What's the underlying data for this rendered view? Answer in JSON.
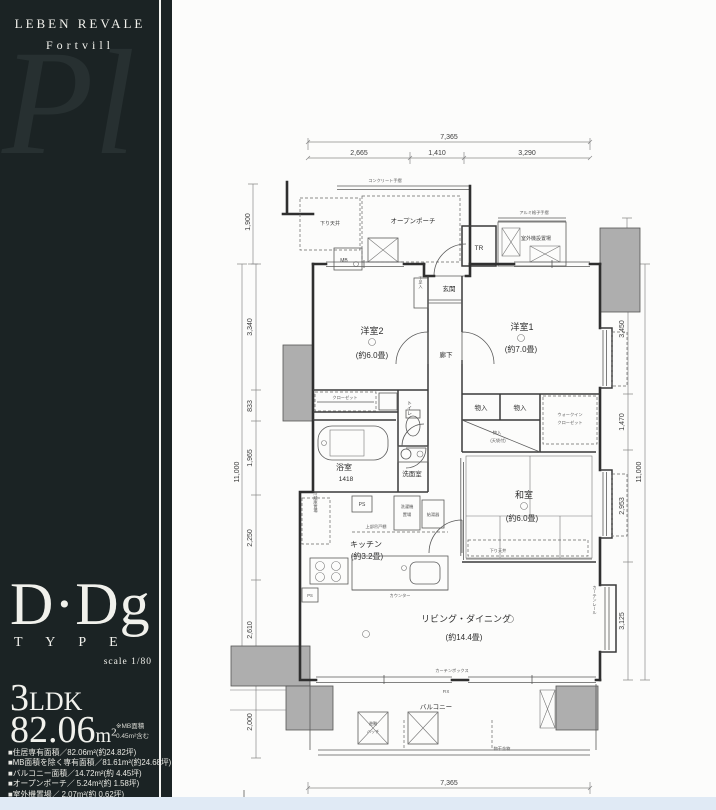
{
  "sidebar": {
    "brand_line1": "LEBEN REVALE",
    "brand_line2": "Fortvill",
    "watermark": "Pl",
    "type_main": "D·Dg",
    "type_sub": "T Y P E",
    "scale": "scale 1/80",
    "ldk_number": "3",
    "ldk_suffix": "LDK",
    "area_value": "82.06",
    "area_unit": "m",
    "area_sup": "2",
    "area_note1": "※MB面積",
    "area_note2": "0.45m²含む",
    "specs": [
      "■住居専有面積／82.06m²(約24.82坪)",
      "■MB面積を除く専有面積／81.61m²(約24.68坪)",
      "■バルコニー面積／14.72m²(約 4.45坪)",
      "■オープンポーチ／ 5.24m²(約 1.58坪)",
      "■室外機置場／ 2.07m²(約 0.62坪)",
      "■トランクルーム／ 0.60m²(約 0.18坪)"
    ]
  },
  "plan": {
    "labels": {
      "concrete_rail": "コンクリート手摺",
      "sagari_tenjo": "下り天井",
      "open_porch": "オープンポーチ",
      "alumi_rail": "アルミ格子手摺",
      "outdoor_unit": "室外機設置場",
      "tr": "TR",
      "mb": "MB",
      "genkan": "玄関",
      "geta": "下足入",
      "rouka": "廊下",
      "yoshitsu2": "洋室2",
      "yoshitsu2_size": "(約6.0畳)",
      "yoshitsu1": "洋室1",
      "yoshitsu1_size": "(約7.0畳)",
      "closet": "クローゼット",
      "toilet": "トイレ",
      "bath": "浴室",
      "bath_size": "1418",
      "senmen": "洗面室",
      "monoire_a": "物入",
      "monoire_b": "物入",
      "wic_1": "ウォークイン",
      "wic_2": "クローゼット",
      "monoire_ten_1": "物入",
      "monoire_ten_2": "(天袋付)",
      "washitsu": "和室",
      "washitsu_size": "(約6.0畳)",
      "sagari_tenjo2": "下り天井",
      "ps": "PS",
      "ps2": "PS",
      "sentakuki_1": "洗濯機",
      "sentakuki_2": "置場",
      "kyutoki": "給湯器",
      "tsuridana": "上部吊戸棚",
      "reizoko": "冷蔵庫置場",
      "kitchen": "キッチン",
      "kitchen_size": "(約3.2畳)",
      "counter": "カウンター",
      "living": "リビング・ダイニング",
      "living_size": "(約14.4畳)",
      "curtain_box": "カーテンボックス",
      "curtain_rail": "カーテンレール",
      "fix": "FIX",
      "balcony": "バルコニー",
      "hatch_1": "避難",
      "hatch_2": "ハッチ",
      "monohoshi": "物干金物",
      "north": "N"
    },
    "dims": {
      "top_total": "7,365",
      "top_seg1": "2,665",
      "top_seg2": "1,410",
      "top_seg3": "3,290",
      "left_upper": "1,900",
      "left_total": "11,000",
      "l1": "3,340",
      "l2": "833",
      "l3": "1,965",
      "l4": "2,250",
      "l5": "2,610",
      "left_lower": "2,000",
      "right_upper": "1,200",
      "right_total": "11,000",
      "r1": "3,450",
      "r2": "1,470",
      "r3": "2,953",
      "r4": "3,125",
      "bottom_total": "7,365"
    }
  },
  "colors": {
    "sidebar_bg": "#1b2324",
    "paper": "#fcfcfb",
    "wall": "#2f2f2f",
    "neighbor_gray": "#aeaeae",
    "foot_strip": "#e0eaf5"
  }
}
